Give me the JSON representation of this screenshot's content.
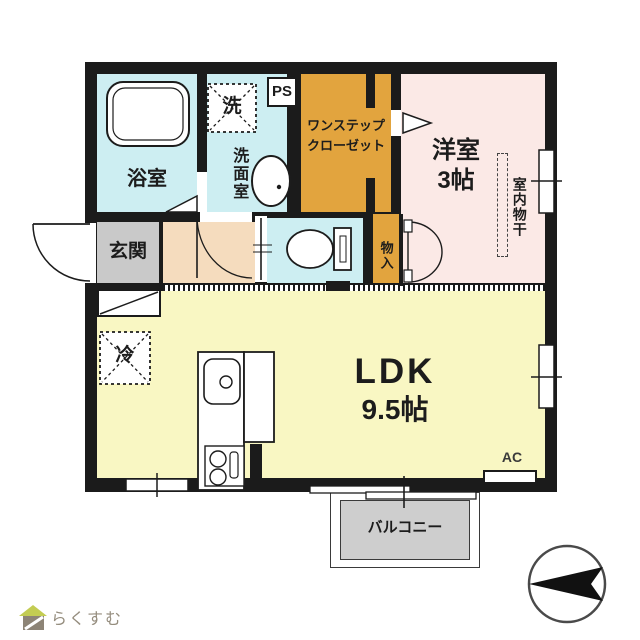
{
  "plan": {
    "bathroom": {
      "label": "浴室"
    },
    "washroom": {
      "label": "洗面室",
      "washer": "洗"
    },
    "pipe_space": {
      "label": "PS"
    },
    "closet": {
      "line1": "ワンステップ",
      "line2": "クローゼット"
    },
    "western_room": {
      "line1": "洋室",
      "line2": "3帖",
      "indoor_drying": "室内物干"
    },
    "entrance": {
      "label": "玄関"
    },
    "storage": {
      "label": "物入"
    },
    "ldk": {
      "line1": "LDK",
      "line2": "9.5帖",
      "fridge": "冷",
      "ac": "AC"
    },
    "balcony": {
      "label": "バルコニー"
    }
  },
  "branding": {
    "logo": "らくすむ"
  },
  "colors": {
    "wall": "#1b1b1b",
    "line": "#1c1c1c",
    "wet": "#cdeef2",
    "closet": "#e2a43e",
    "western": "#fbe9e6",
    "ldk": "#f9f7c3",
    "entrance": "#c9c9c9",
    "hall": "#f5dcbe",
    "balcony": "#cecece",
    "logo_green": "#c3cc52",
    "logo_text": "#958d7e"
  }
}
